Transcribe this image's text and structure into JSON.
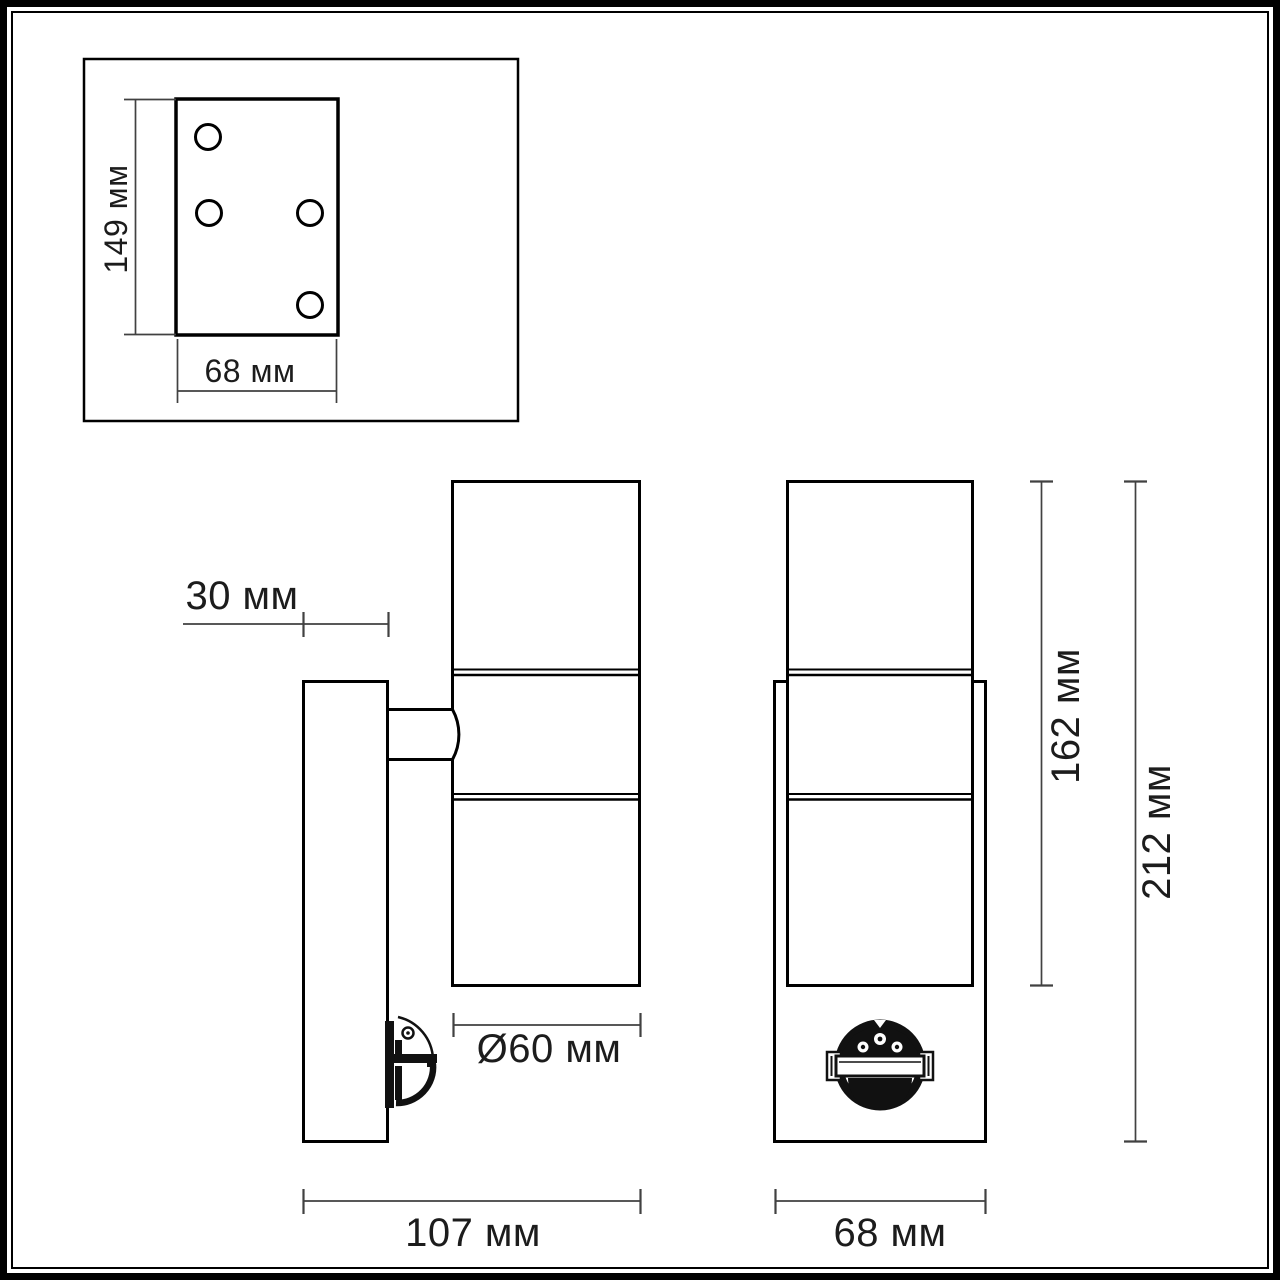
{
  "drawing": {
    "type": "technical-dimension-diagram",
    "subject": "wall luminaire with motion sensor",
    "mounting_plate_view": {
      "height_label": "149 мм",
      "width_label": "68 мм",
      "hole_count": 4
    },
    "side_view": {
      "wall_plate_depth_label": "30 мм",
      "body_diameter_label": "Ø60 мм",
      "total_depth_label": "107 мм"
    },
    "front_view": {
      "body_height_label": "162 мм",
      "total_height_label": "212 мм",
      "width_label": "68 мм"
    },
    "colors": {
      "background": "#ffffff",
      "outline": "#000000",
      "dimension_line": "#414141",
      "text": "#1c1c1c"
    }
  }
}
